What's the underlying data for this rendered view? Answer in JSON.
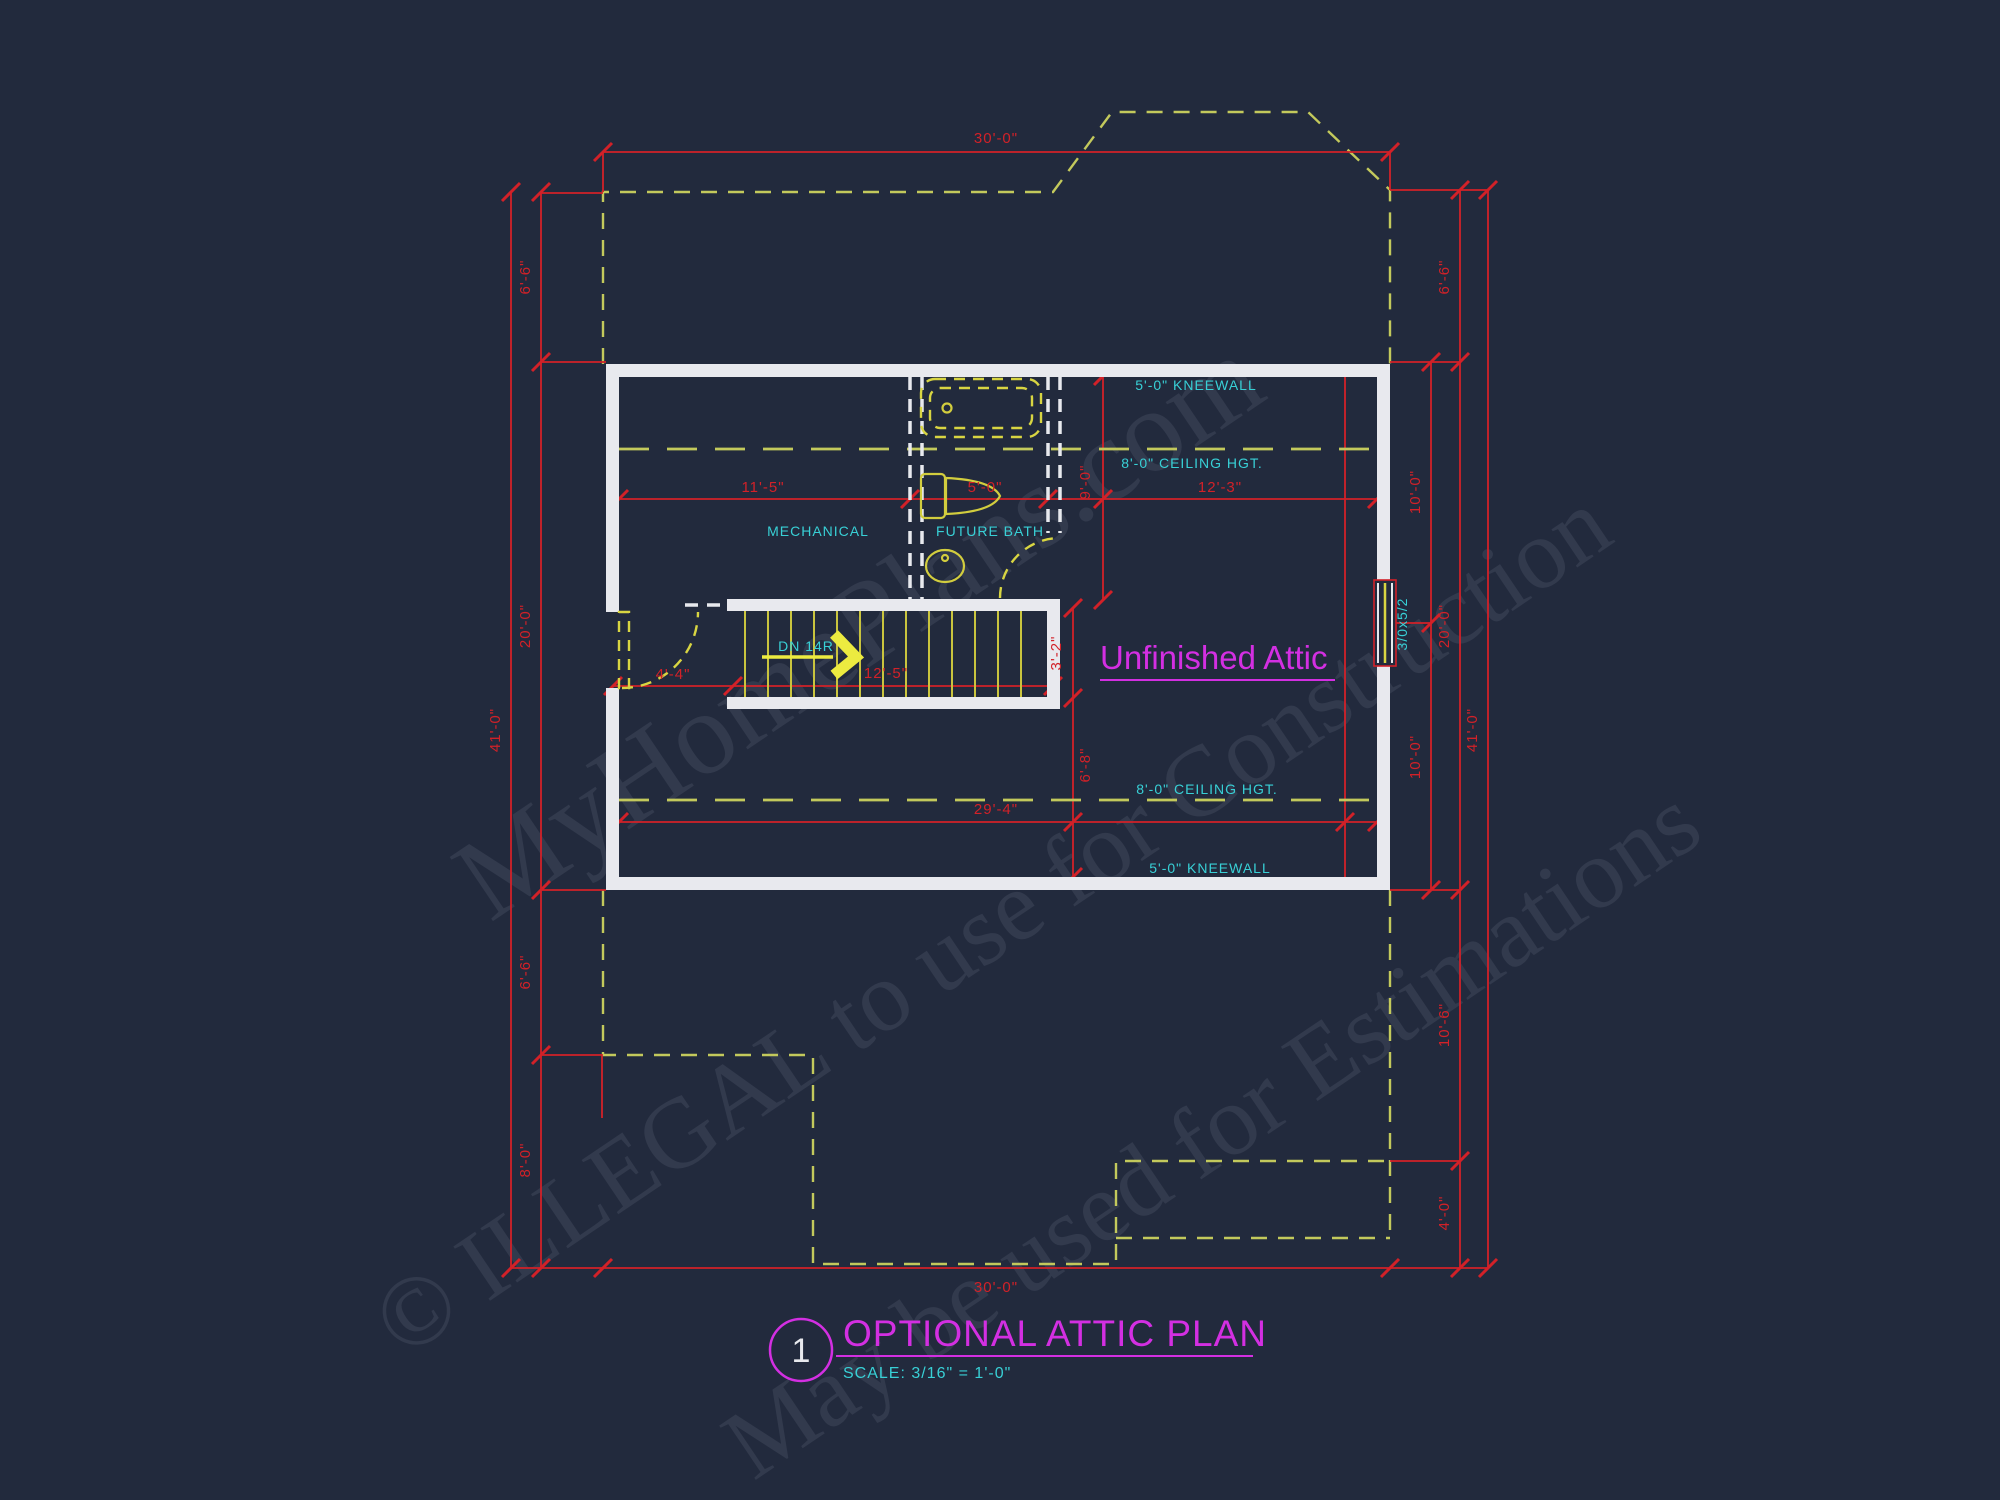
{
  "title_block": {
    "number": "1",
    "title": "OPTIONAL ATTIC PLAN",
    "scale": "SCALE: 3/16\" = 1'-0\""
  },
  "rooms": {
    "attic": "Unfinished Attic",
    "mechanical": "MECHANICAL",
    "future_bath": "FUTURE BATH"
  },
  "notes": {
    "kneewall_top": "5'-0\" KNEEWALL",
    "kneewall_bottom": "5'-0\" KNEEWALL",
    "ceiling_top": "8'-0\" CEILING HGT.",
    "ceiling_bottom": "8'-0\" CEILING HGT.",
    "stair_direction": "DN 14R",
    "window_size": "3/0x5/2"
  },
  "dimensions": {
    "top": "30'-0\"",
    "bottom": "30'-0\"",
    "left_outer": "41'-0\"",
    "left_upper": "6'-6\"",
    "left_mid": "20'-0\"",
    "left_lower_mid": "6'-6\"",
    "left_lower": "8'-0\"",
    "right_outer": "41'-0\"",
    "right_upper": "6'-6\"",
    "right_mid": "20'-0\"",
    "right_inner_upper": "10'-0\"",
    "right_inner_lower": "10'-0\"",
    "right_lower": "10'-6\"",
    "right_bottom": "4'-0\"",
    "int_left": "11'-5\"",
    "int_bath": "5'-0\"",
    "int_right": "12'-3\"",
    "int_vert_upper": "9'-0\"",
    "stair_height": "3'-2\"",
    "int_vert_lower": "6'-8\"",
    "int_bottom": "29'-4\"",
    "stair_left": "4'-4\"",
    "stair_run": "12'-5\""
  },
  "watermarks": {
    "line1": "MyHomePlans.com",
    "line2": "© ILLEGAL to use for Construction",
    "line3": "May be used for Estimations"
  },
  "colors": {
    "background": "#222a3d",
    "dimension_red": "#d22128",
    "outline_yellow_green": "#c3c95c",
    "fixture_yellow": "#d8d542",
    "annotation_cyan": "#38d0d6",
    "title_magenta": "#d32fe2",
    "wall_white": "#e8e9ee"
  }
}
